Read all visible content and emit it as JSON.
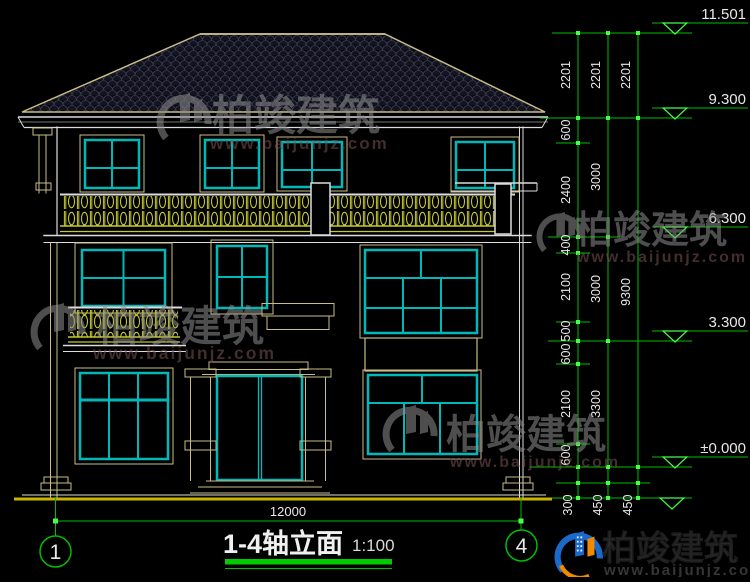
{
  "drawing": {
    "title": "1-4轴立面",
    "scale": "1:100",
    "axis_left": "1",
    "axis_right": "4",
    "width_dim": "12000",
    "elevations": {
      "ridge": "11.501",
      "eave": "9.300",
      "floor3": "6.300",
      "floor2": "3.300",
      "zero": "±0.000"
    },
    "chain1": [
      "2201",
      "600",
      "2400",
      "400",
      "2100",
      "500",
      "600",
      "2100",
      "600",
      "300"
    ],
    "chain2": [
      "2201",
      "3000",
      "3000",
      "3300",
      "450"
    ],
    "chain3": [
      "2201",
      "9300",
      "450"
    ]
  },
  "watermark": {
    "brand": "柏竣建筑",
    "url": "www.baijunjz.com"
  },
  "colors": {
    "line_tan": "#C9BC84",
    "line_white": "#DCDCDC",
    "window_cyan": "#00B8B8",
    "railing_yellow": "#C6C832",
    "dim_green": "#00BE00",
    "tick_green": "#44FF44",
    "logo_blue": "#1B6ACB",
    "logo_orange": "#F08A00"
  }
}
